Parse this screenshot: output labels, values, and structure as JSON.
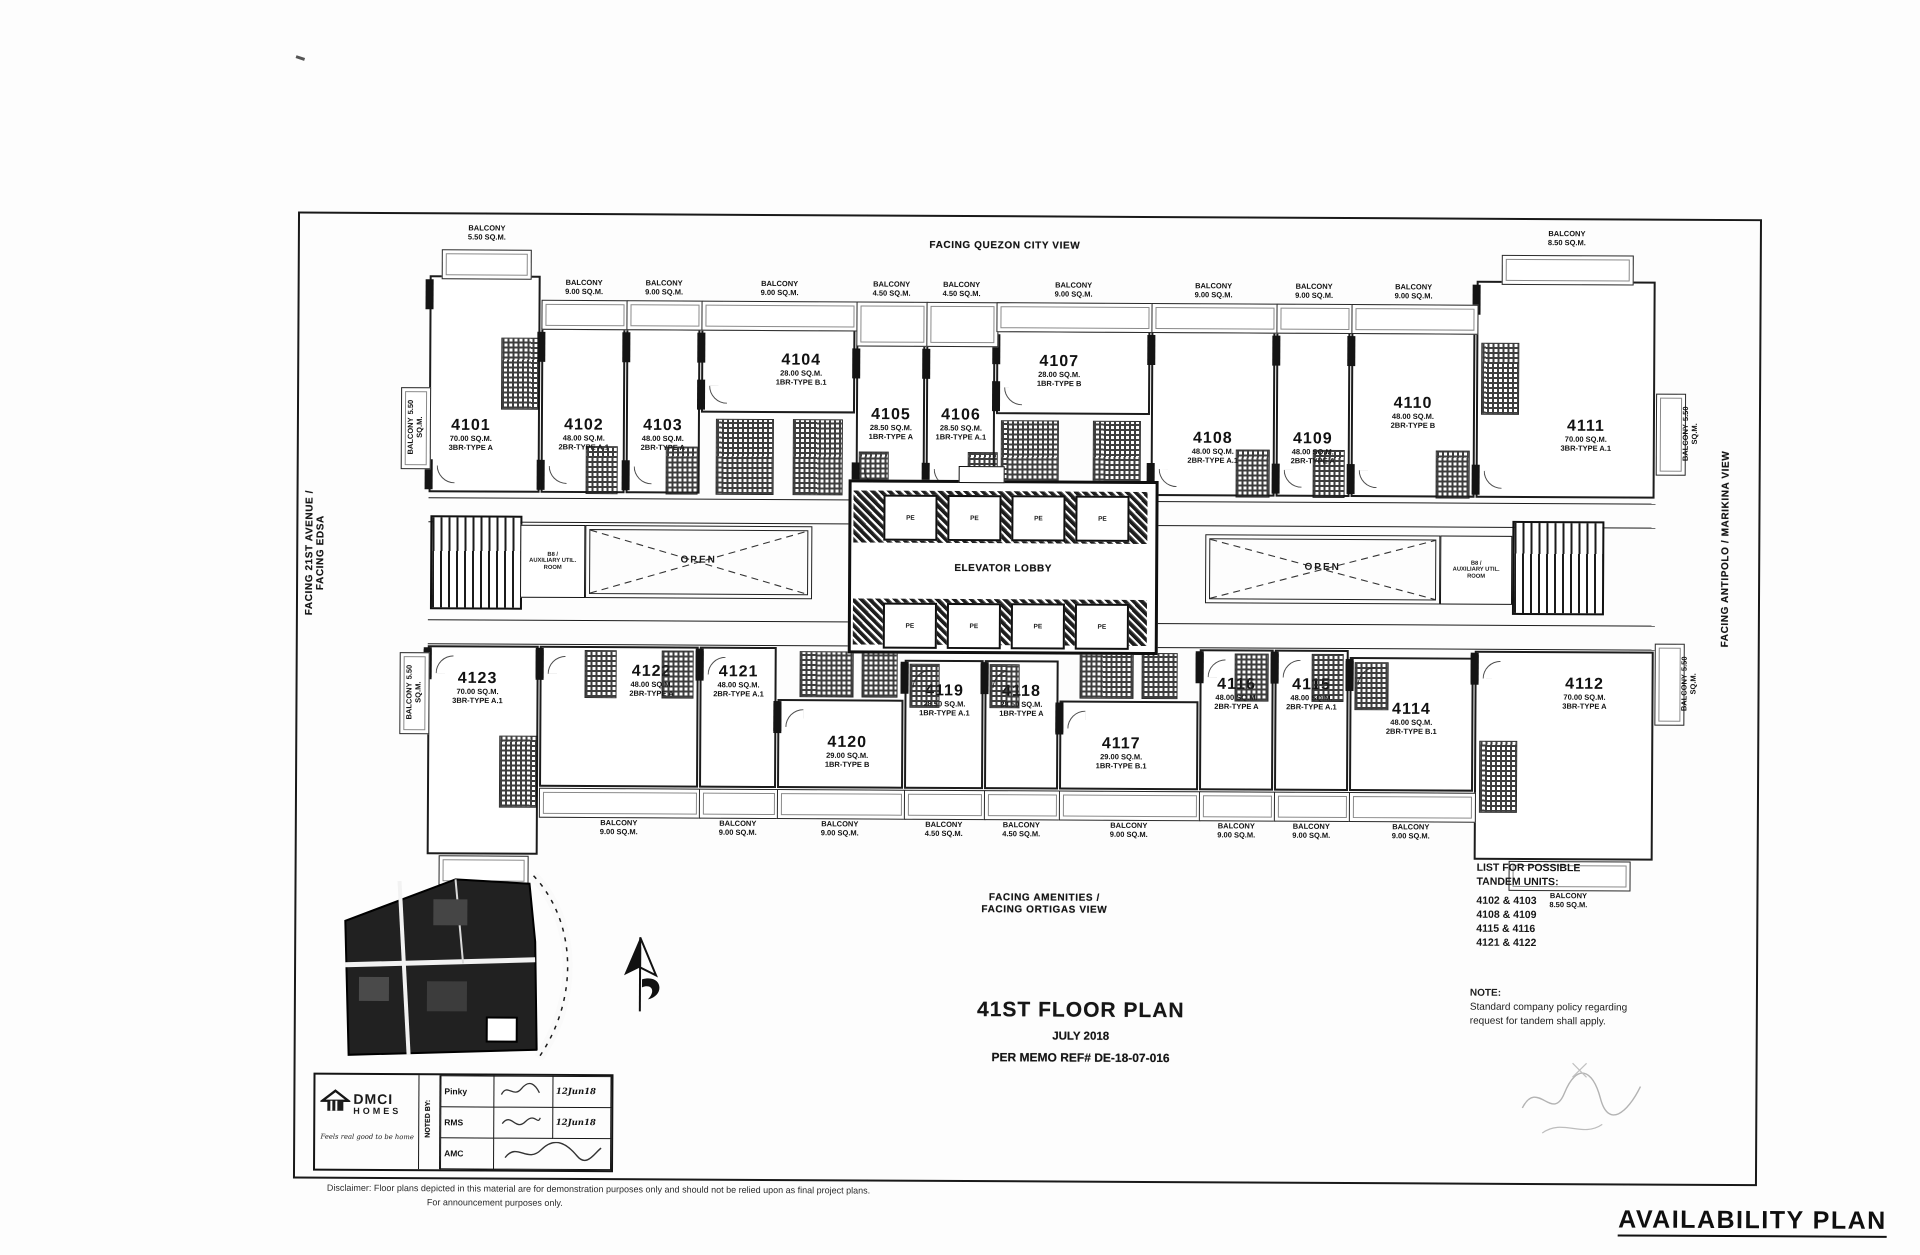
{
  "labels": {
    "balcony": "BALCONY",
    "facing_top": "FACING QUEZON CITY VIEW",
    "facing_bottom_1": "FACING AMENITIES /",
    "facing_bottom_2": "FACING ORTIGAS VIEW",
    "facing_left_1": "FACING 21ST AVENUE /",
    "facing_left_2": "FACING EDSA",
    "facing_right": "FACING ANTIPOLO / MARIKINA VIEW"
  },
  "core": {
    "elevator_lobby": "ELEVATOR LOBBY",
    "elevator_cab": "PE",
    "open": "OPEN",
    "aux_line1": "B8 /",
    "aux_line2": "AUXILIARY UTIL.",
    "aux_line3": "ROOM"
  },
  "units": {
    "top_row": [
      {
        "number": "4101",
        "area": "70.00 SQ.M.",
        "type": "3BR-TYPE A"
      },
      {
        "number": "4102",
        "area": "48.00 SQ.M.",
        "type": "2BR-TYPE A.1"
      },
      {
        "number": "4103",
        "area": "48.00 SQ.M.",
        "type": "2BR-TYPE A"
      },
      {
        "number": "4104",
        "area": "28.00 SQ.M.",
        "type": "1BR-TYPE B.1"
      },
      {
        "number": "4105",
        "area": "28.50 SQ.M.",
        "type": "1BR-TYPE A"
      },
      {
        "number": "4106",
        "area": "28.50 SQ.M.",
        "type": "1BR-TYPE A.1"
      },
      {
        "number": "4107",
        "area": "28.00 SQ.M.",
        "type": "1BR-TYPE B"
      },
      {
        "number": "4108",
        "area": "48.00 SQ.M.",
        "type": "2BR-TYPE A.1"
      },
      {
        "number": "4109",
        "area": "48.00 SQ.M.",
        "type": "2BR-TYPE A"
      },
      {
        "number": "4110",
        "area": "48.00 SQ.M.",
        "type": "2BR-TYPE B"
      },
      {
        "number": "4111",
        "area": "70.00 SQ.M.",
        "type": "3BR-TYPE A.1"
      }
    ],
    "bottom_row": [
      {
        "number": "4123",
        "area": "70.00 SQ.M.",
        "type": "3BR-TYPE A.1"
      },
      {
        "number": "4122",
        "area": "48.00 SQ.M.",
        "type": "2BR-TYPE A"
      },
      {
        "number": "4121",
        "area": "48.00 SQ.M.",
        "type": "2BR-TYPE A.1"
      },
      {
        "number": "4120",
        "area": "29.00 SQ.M.",
        "type": "1BR-TYPE B"
      },
      {
        "number": "4119",
        "area": "28.50 SQ.M.",
        "type": "1BR-TYPE A.1"
      },
      {
        "number": "4118",
        "area": "28.50 SQ.M.",
        "type": "1BR-TYPE A"
      },
      {
        "number": "4117",
        "area": "29.00 SQ.M.",
        "type": "1BR-TYPE B.1"
      },
      {
        "number": "4116",
        "area": "48.00 SQ.M.",
        "type": "2BR-TYPE A"
      },
      {
        "number": "4115",
        "area": "48.00 SQ.M.",
        "type": "2BR-TYPE A.1"
      },
      {
        "number": "4114",
        "area": "48.00 SQ.M.",
        "type": "2BR-TYPE B.1"
      },
      {
        "number": "4112",
        "area": "70.00 SQ.M.",
        "type": "3BR-TYPE A"
      }
    ]
  },
  "balconies": {
    "top": [
      {
        "area": "5.50 SQ.M."
      },
      {
        "area": "9.00 SQ.M."
      },
      {
        "area": "9.00 SQ.M."
      },
      {
        "area": "9.00 SQ.M."
      },
      {
        "area": "4.50 SQ.M."
      },
      {
        "area": "4.50 SQ.M."
      },
      {
        "area": "9.00 SQ.M."
      },
      {
        "area": "9.00 SQ.M."
      },
      {
        "area": "9.00 SQ.M."
      },
      {
        "area": "9.00 SQ.M."
      },
      {
        "area": "8.50 SQ.M."
      }
    ],
    "bottom": [
      {
        "area": "8.50 SQ.M."
      },
      {
        "area": "9.00 SQ.M."
      },
      {
        "area": "9.00 SQ.M."
      },
      {
        "area": "9.00 SQ.M."
      },
      {
        "area": "4.50 SQ.M."
      },
      {
        "area": "4.50 SQ.M."
      },
      {
        "area": "9.00 SQ.M."
      },
      {
        "area": "9.00 SQ.M."
      },
      {
        "area": "9.00 SQ.M."
      },
      {
        "area": "9.00 SQ.M."
      },
      {
        "area": "8.50 SQ.M."
      }
    ],
    "side": [
      {
        "area": "5.50 SQ.M."
      },
      {
        "area": "5.50 SQ.M."
      },
      {
        "area": "5.50 SQ.M."
      },
      {
        "area": "5.50 SQ.M."
      }
    ]
  },
  "title_block": {
    "title": "41ST FLOOR PLAN",
    "date": "JULY 2018",
    "memo": "PER MEMO REF# DE-18-07-016"
  },
  "tandem": {
    "heading1": "LIST FOR POSSIBLE",
    "heading2": "TANDEM UNITS:",
    "pairs": [
      "4102 & 4103",
      "4108 & 4109",
      "4115 & 4116",
      "4121 & 4122"
    ]
  },
  "note": {
    "label": "NOTE:",
    "line1": "Standard company policy regarding",
    "line2": "request for tandem shall apply."
  },
  "footer": {
    "availability": "AVAILABILITY PLAN",
    "disclaimer1": "Disclaimer: Floor plans depicted in this material are for demonstration purposes only and should not be relied upon as final project plans.",
    "disclaimer2": "For announcement purposes only."
  },
  "noted_by": {
    "label": "NOTED BY:",
    "rows": [
      {
        "name": "Pinky",
        "note": "12Jun18"
      },
      {
        "name": "RMS",
        "note": "12Jun18"
      },
      {
        "name": "AMC",
        "note": ""
      }
    ]
  },
  "brand": {
    "name1": "DMCI",
    "name2": "HOMES",
    "tagline": "Feels real good to be home"
  }
}
